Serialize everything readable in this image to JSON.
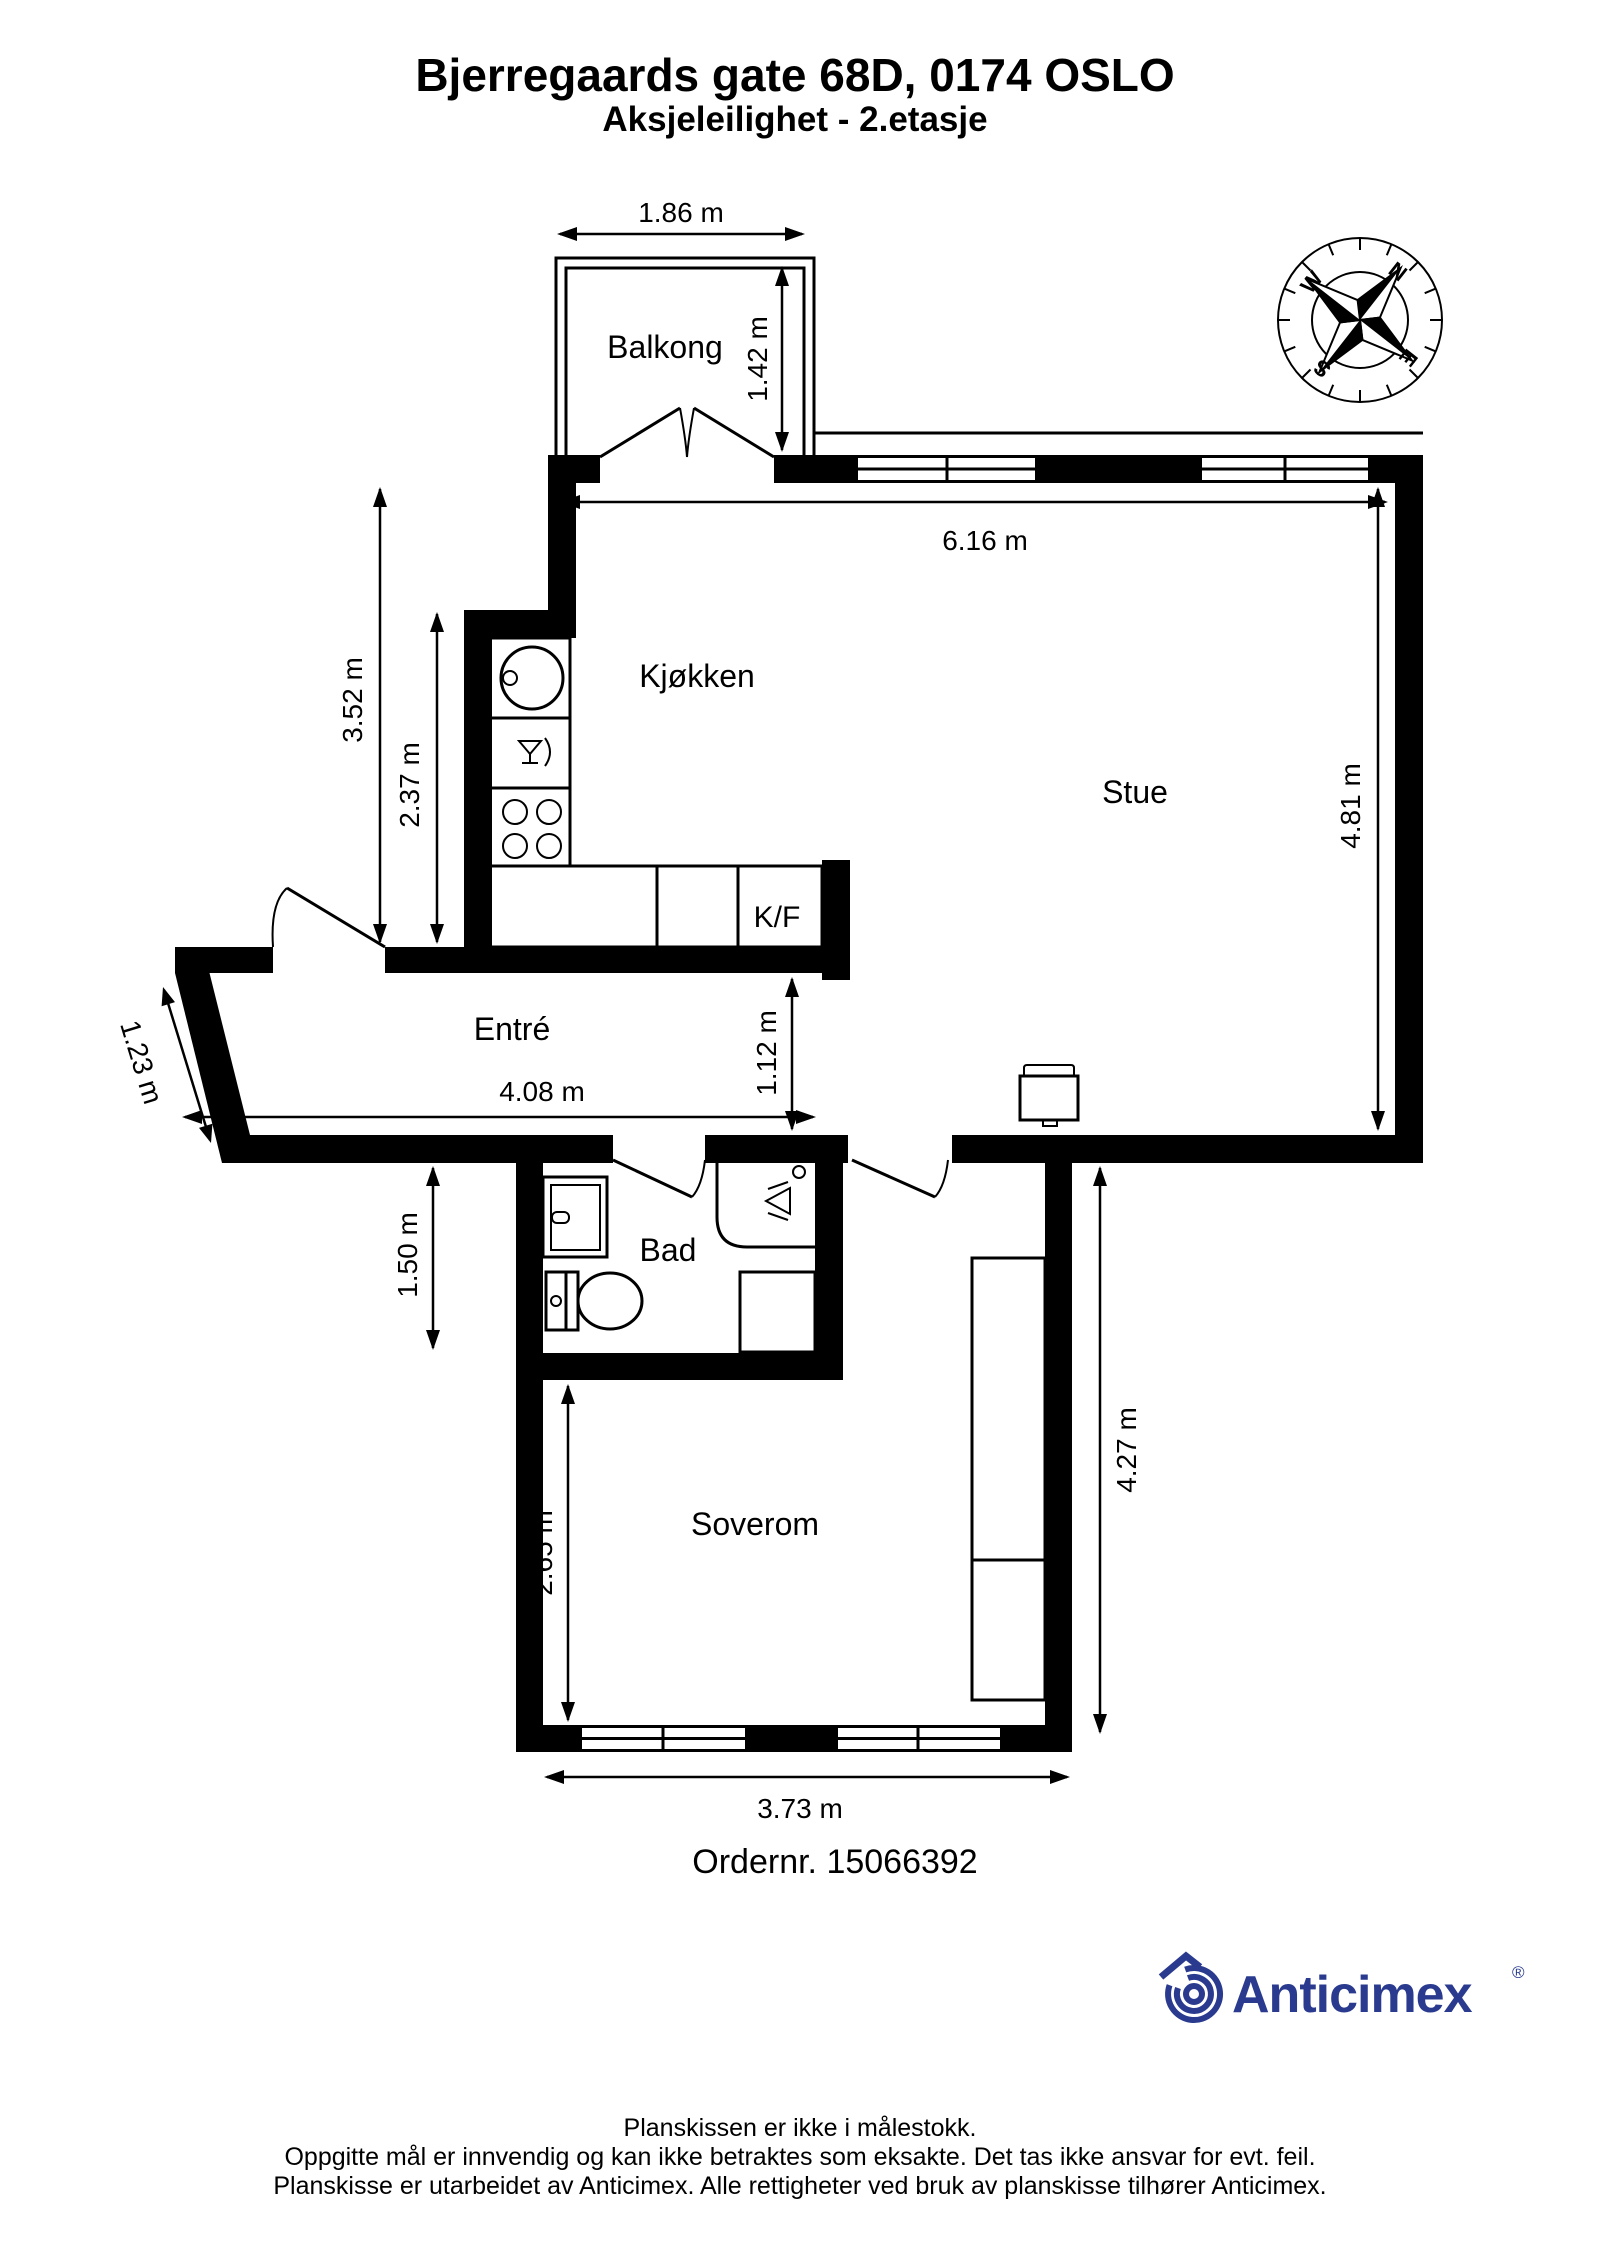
{
  "header": {
    "title": "Bjerregaards gate 68D, 0174 OSLO",
    "subtitle": "Aksjeleilighet  - 2.etasje"
  },
  "rooms": {
    "balkong": "Balkong",
    "kjokken": "Kjøkken",
    "stue": "Stue",
    "entre": "Entré",
    "bad": "Bad",
    "soverom": "Soverom",
    "kf": "K/F"
  },
  "dims": {
    "balcony_width": "1.86 m",
    "balcony_depth": "1.42 m",
    "stue_width": "6.16 m",
    "kitchen_outer": "3.52 m",
    "kitchen_inner": "2.37 m",
    "stue_height": "4.81 m",
    "entrance_diag": "1.23 m",
    "entre_width": "4.08 m",
    "passage": "1.12 m",
    "bad_height": "1.50 m",
    "soverom_height": "2.65 m",
    "right_wing_height": "4.27 m",
    "soverom_width": "3.73 m"
  },
  "order": {
    "label": "Ordernr. 15066392"
  },
  "compass": {
    "n": "N",
    "e": "E",
    "s": "S",
    "w": "W"
  },
  "logo": {
    "brand": "Anticimex",
    "registered": "®"
  },
  "footer": {
    "line1": "Planskissen er ikke i målestokk.",
    "line2": "Oppgitte mål er innvendig og kan ikke betraktes som eksakte. Det tas ikke ansvar for evt. feil.",
    "line3": "Planskisse er utarbeidet av Anticimex. Alle rettigheter ved bruk av planskisse tilhører Anticimex."
  },
  "colors": {
    "ink": "#000000",
    "brand_navy": "#2a3b8f",
    "background": "#ffffff"
  }
}
